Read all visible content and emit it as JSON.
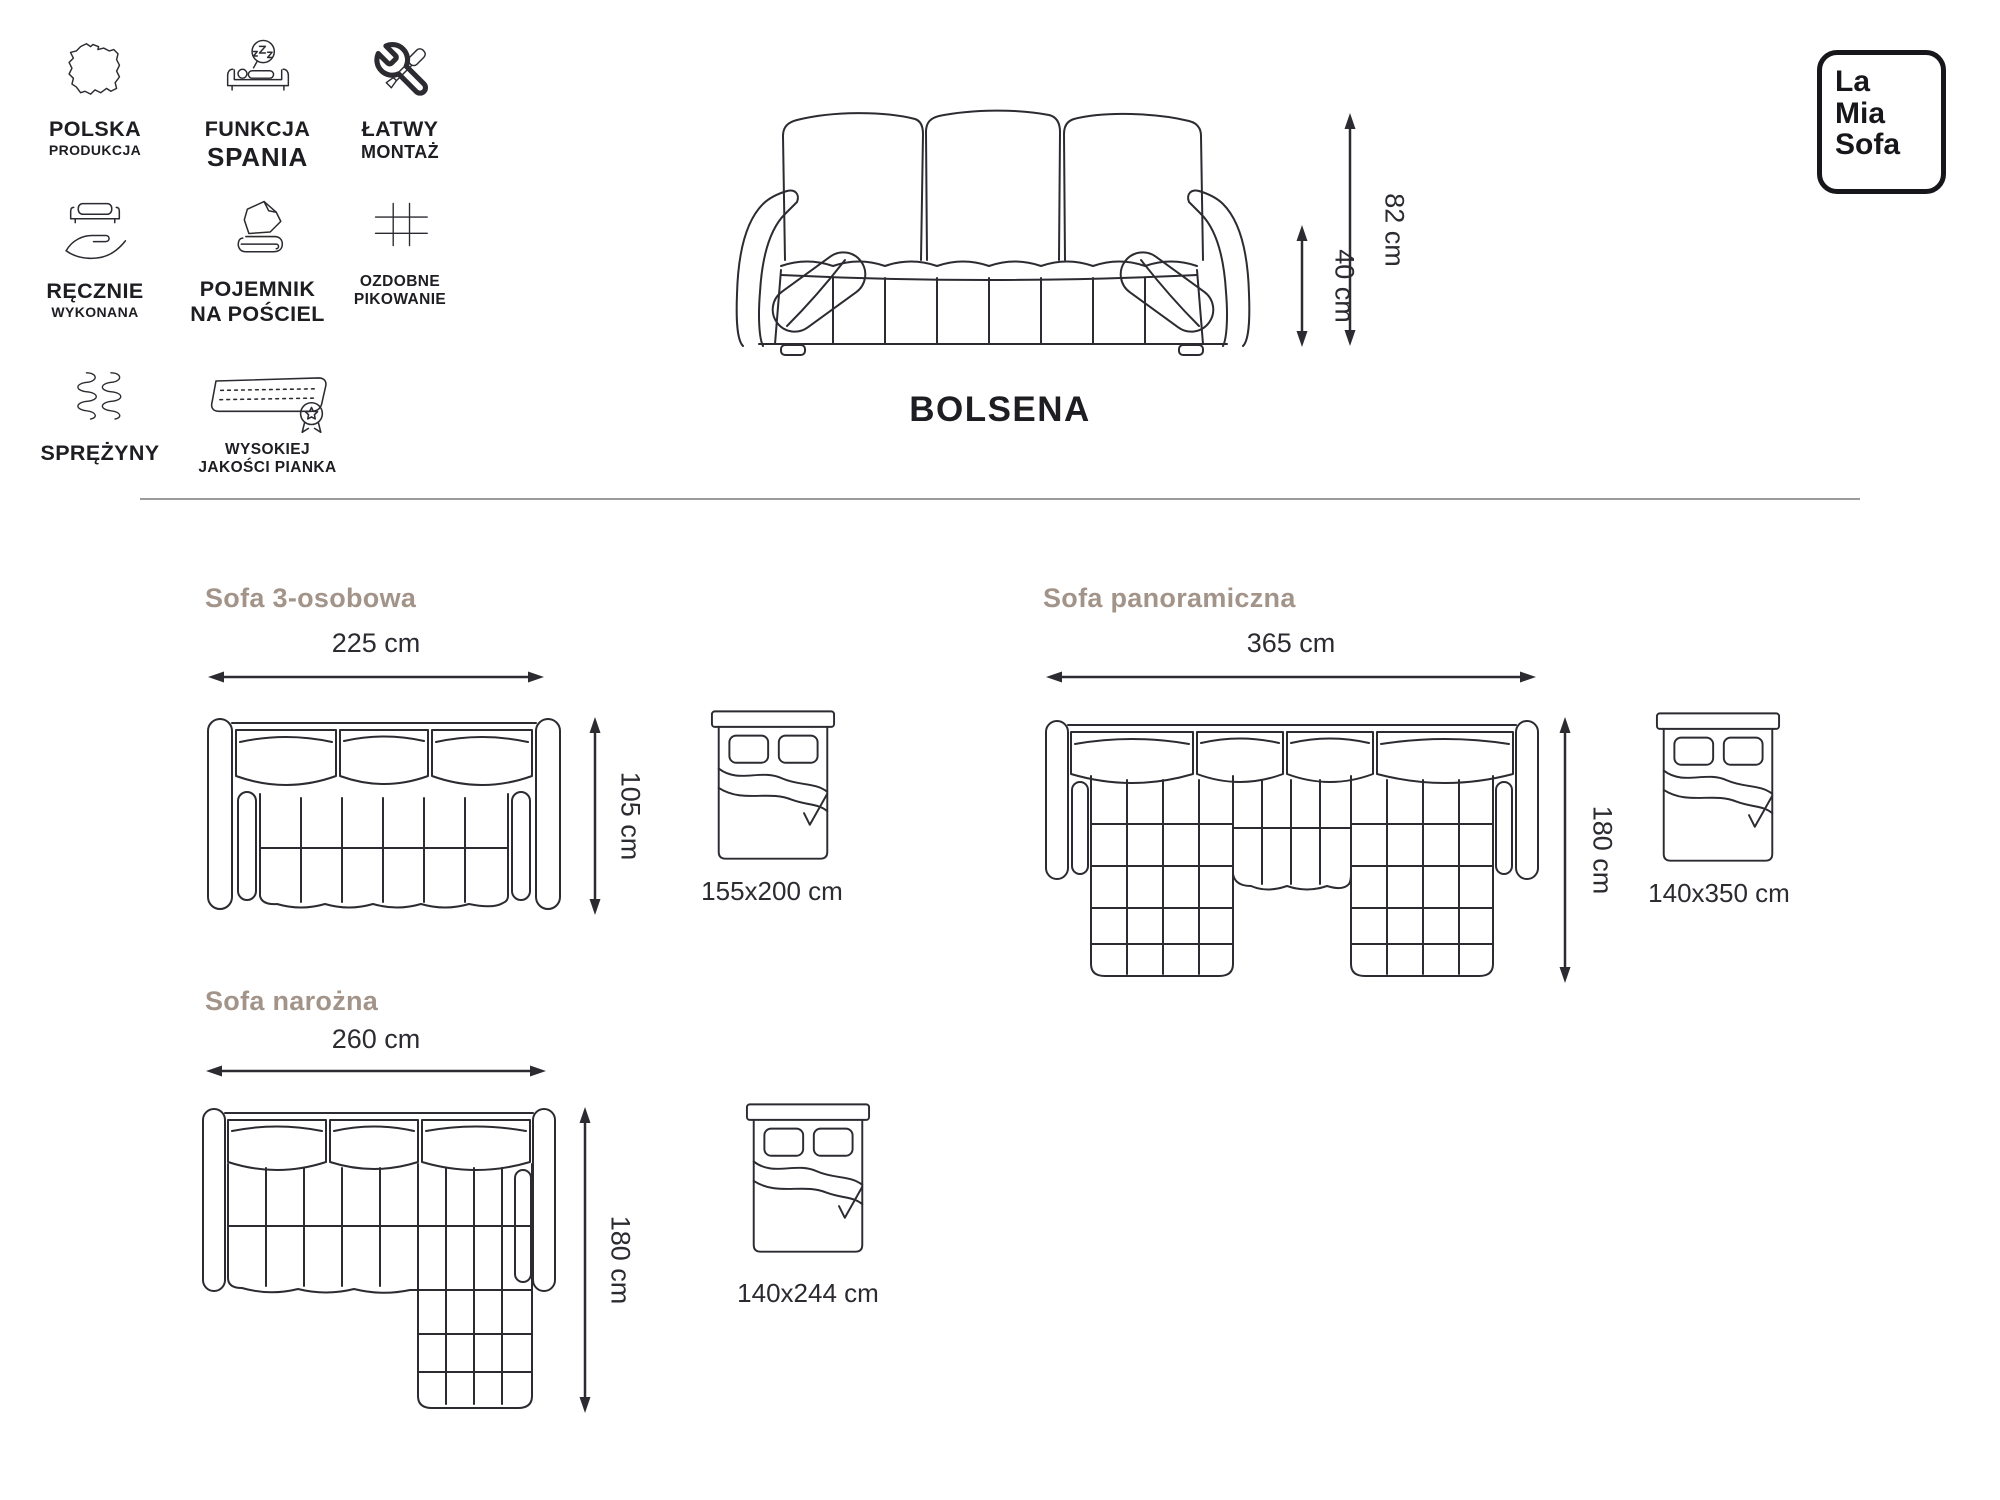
{
  "product": {
    "name": "BOLSENA",
    "overall_height": "82 cm",
    "seat_height": "40 cm"
  },
  "logo": {
    "lines": [
      "La",
      "Mia",
      "Sofa"
    ]
  },
  "colors": {
    "line_art": "#2b2b31",
    "text": "#1d1d22",
    "section_title": "#a3948a",
    "divider": "#9b9b9b"
  },
  "features": [
    {
      "icon": "poland-map-icon",
      "lines": [
        "POLSKA",
        "PRODUKCJA"
      ]
    },
    {
      "icon": "sleep-function-icon",
      "lines": [
        "FUNKCJA",
        "SPANIA"
      ]
    },
    {
      "icon": "easy-assembly-icon",
      "lines": [
        "ŁATWY",
        "MONTAŻ"
      ]
    },
    {
      "icon": "handmade-icon",
      "lines": [
        "RĘCZNIE",
        "WYKONANA"
      ]
    },
    {
      "icon": "bedding-storage-icon",
      "lines": [
        "POJEMNIK",
        "NA POŚCIEL"
      ]
    },
    {
      "icon": "quilting-icon",
      "lines": [
        "OZDOBNE",
        "PIKOWANIE"
      ]
    },
    {
      "icon": "springs-icon",
      "lines": [
        "SPRĘŻYNY"
      ]
    },
    {
      "icon": "foam-quality-icon",
      "lines": [
        "WYSOKIEJ",
        "JAKOŚCI PIANKA"
      ]
    }
  ],
  "variants": [
    {
      "title": "Sofa 3-osobowa",
      "width": "225 cm",
      "depth": "105 cm",
      "bed": "155x200 cm"
    },
    {
      "title": "Sofa panoramiczna",
      "width": "365 cm",
      "depth": "180 cm",
      "bed": "140x350 cm"
    },
    {
      "title": "Sofa narożna",
      "width": "260 cm",
      "depth": "180 cm",
      "bed": "140x244 cm"
    }
  ]
}
